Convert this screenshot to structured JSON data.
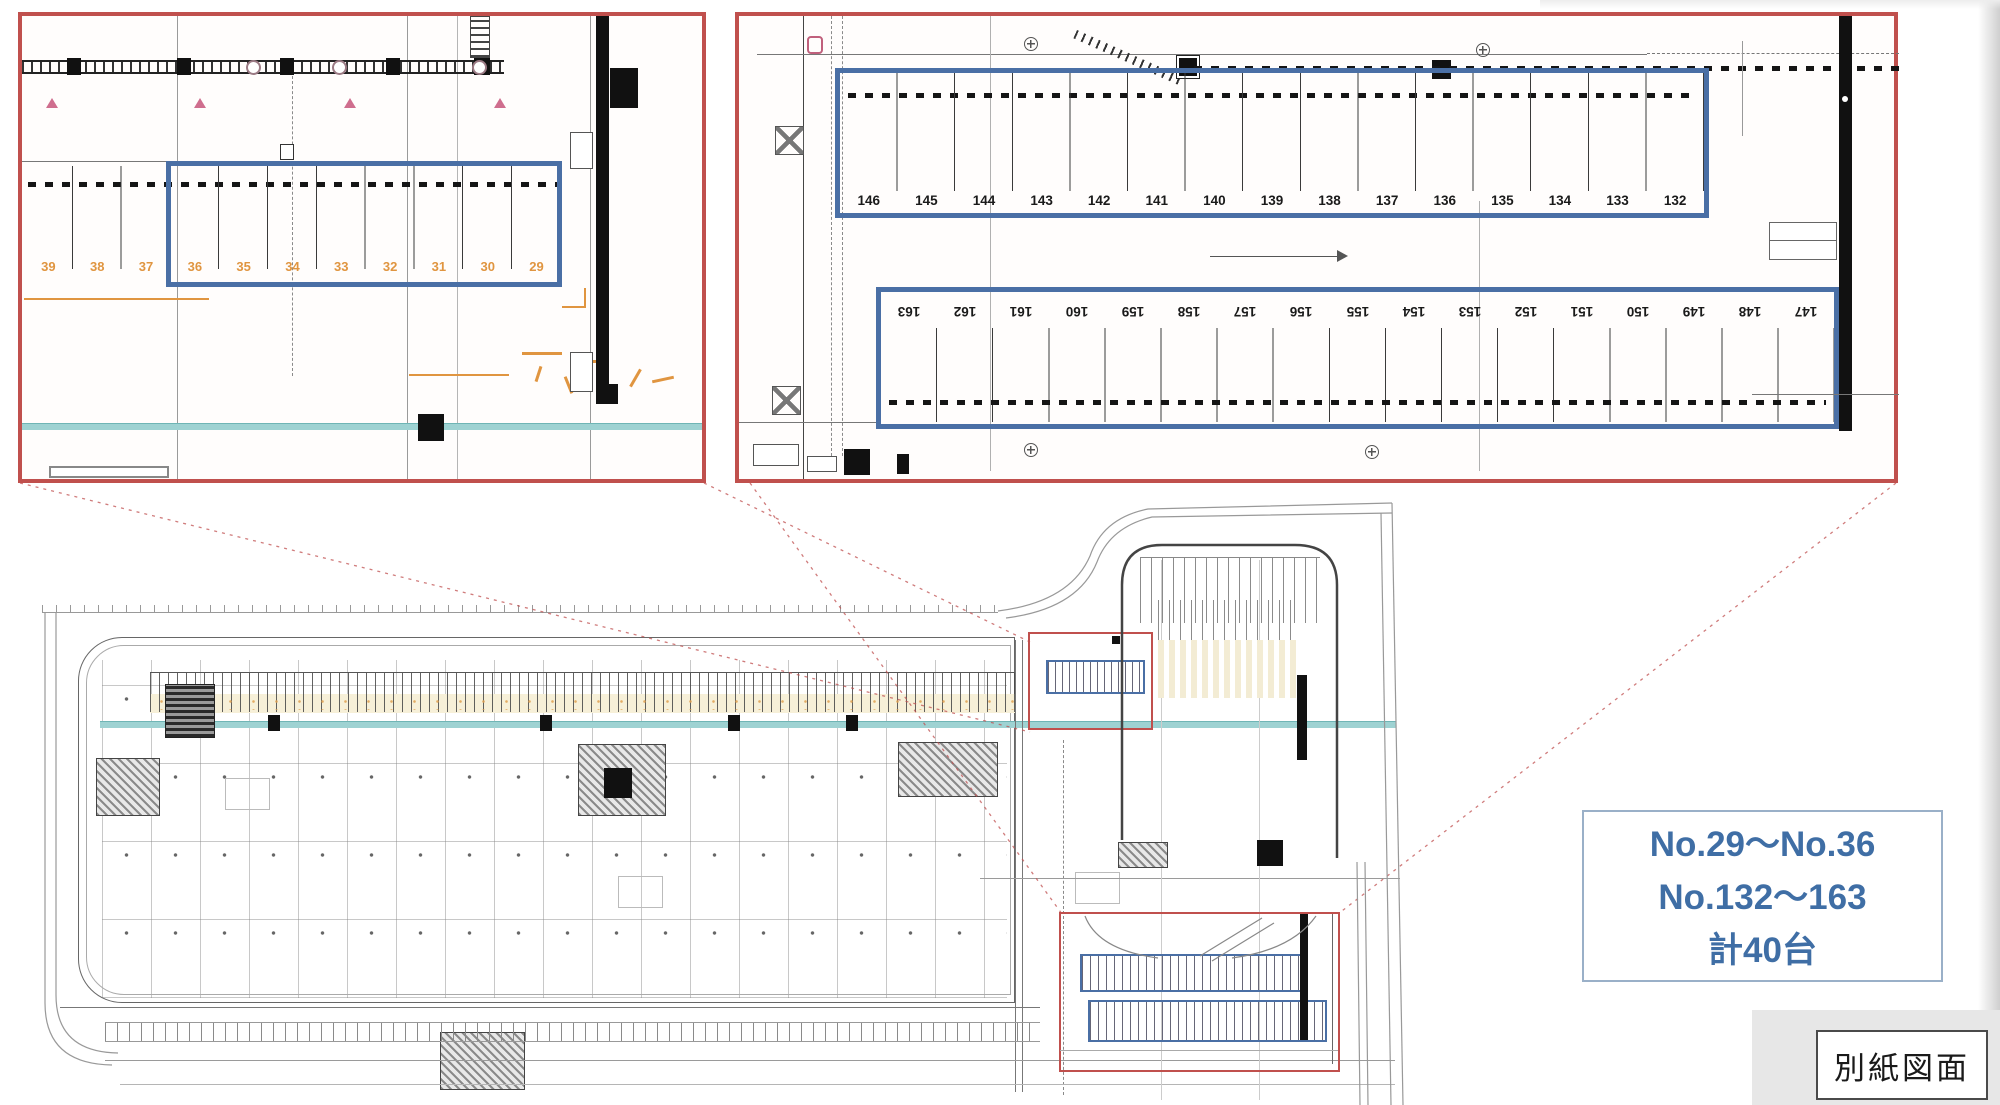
{
  "colors": {
    "callout_red": "#C0504D",
    "highlight_blue": "#4A6FA5",
    "teal_line": "#9ED2D2",
    "orange_number": "#E09540",
    "summary_text": "#3F6EA5"
  },
  "left_inset": {
    "description": "detail-view-spaces-29-36",
    "stall_numbers": [
      "39",
      "38",
      "37",
      "36",
      "35",
      "34",
      "33",
      "32",
      "31",
      "30",
      "29"
    ]
  },
  "right_inset": {
    "description": "detail-view-spaces-132-163",
    "top_row_numbers": [
      "146",
      "145",
      "144",
      "143",
      "142",
      "141",
      "140",
      "139",
      "138",
      "137",
      "136",
      "135",
      "134",
      "133",
      "132"
    ],
    "bottom_row_numbers": [
      "163",
      "162",
      "161",
      "160",
      "159",
      "158",
      "157",
      "156",
      "155",
      "154",
      "153",
      "152",
      "151",
      "150",
      "149",
      "148",
      "147"
    ]
  },
  "summary_box": {
    "line1": "No.29〜No.36",
    "line2": "No.132〜163",
    "line3": "計40台"
  },
  "corner_label": {
    "text": "別紙図面"
  }
}
